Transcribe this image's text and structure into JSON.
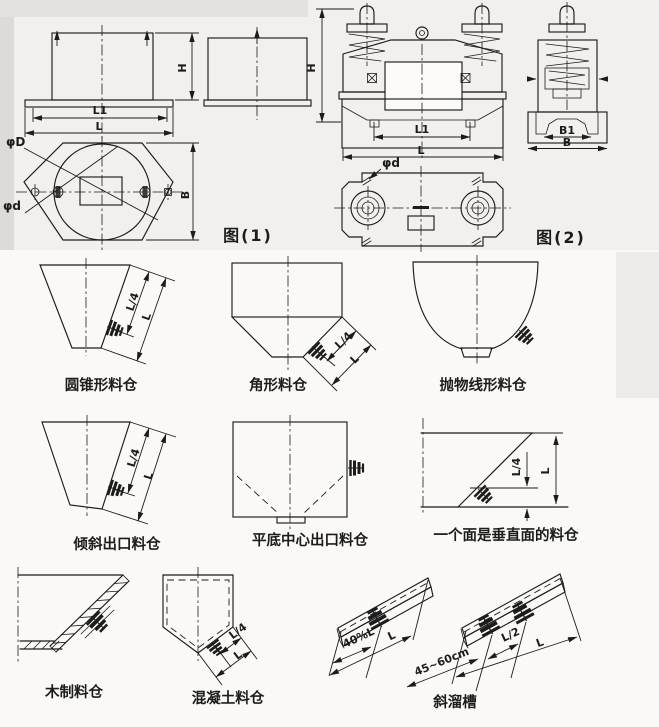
{
  "page": {
    "paper_color": "#faf9f6",
    "ink_color": "#1c1c1c"
  },
  "fig1": {
    "caption": "图(1)",
    "dim_h": "H",
    "dim_l1": "L1",
    "dim_l": "L",
    "dim_phi_D": "φD",
    "dim_phi_d": "φd",
    "dim_b": "B"
  },
  "fig2": {
    "caption": "图(2)",
    "dim_h": "H",
    "dim_l1": "L1",
    "dim_l": "L",
    "dim_b1": "B1",
    "dim_b": "B",
    "dim_phi_d": "φd"
  },
  "hoppers": {
    "conical": {
      "caption": "圆锥形料仓",
      "dim_l4": "L/4",
      "dim_l": "L"
    },
    "angular": {
      "caption": "角形料仓",
      "dim_l4": "L/4",
      "dim_l": "L"
    },
    "parabolic": {
      "caption": "抛物线形料仓"
    },
    "inclined_outlet": {
      "caption": "倾斜出口料仓",
      "dim_l4": "L/4",
      "dim_l": "L"
    },
    "flat_bottom_center": {
      "caption": "平底中心出口料仓"
    },
    "one_vertical_face": {
      "caption": "一个面是垂直面的料仓",
      "dim_l4": "L/4",
      "dim_l": "L"
    },
    "wooden": {
      "caption": "木制料仓"
    },
    "concrete": {
      "caption": "混凝土料仓",
      "dim_l4": "L/4",
      "dim_l": "L"
    },
    "inclined_chute": {
      "caption": "斜溜槽",
      "dim_40l": "40%L",
      "dim_l_single": "L",
      "dim_l2": "L/2",
      "dim_l_full": "L",
      "dim_spacing": "45~60cm"
    }
  }
}
